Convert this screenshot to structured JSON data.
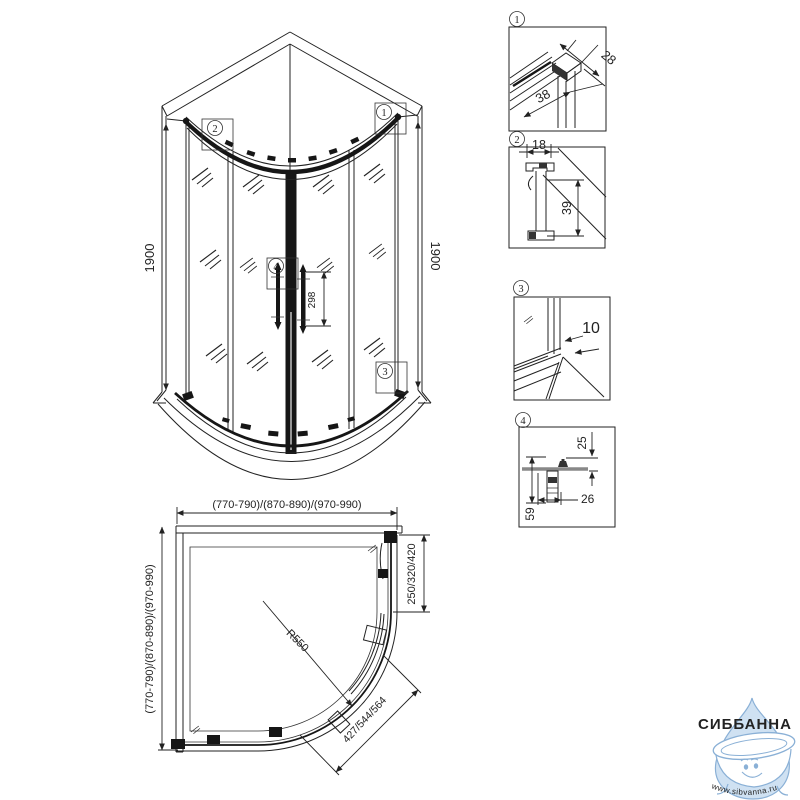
{
  "drawing": {
    "elevation": {
      "height_dim_left": "1900",
      "height_dim_right": "1900",
      "handle_dim": "298"
    },
    "plan": {
      "width_dim": "(770-790)/(870-890)/(970-990)",
      "depth_dim": "(770-790)/(870-890)/(970-990)",
      "side_opening_dim": "250/320/420",
      "door_opening_dim": "427/544/564",
      "radius_dim": "R550"
    },
    "details": {
      "d1": {
        "label": "1",
        "dim_a": "28",
        "dim_b": "38"
      },
      "d2": {
        "label": "2",
        "dim_a": "18",
        "dim_b": "39"
      },
      "d3": {
        "label": "3",
        "dim_a": "10"
      },
      "d4": {
        "label": "4",
        "dim_a": "25",
        "dim_b": "26",
        "dim_c": "59"
      }
    }
  },
  "watermark": {
    "brand": "СИББАННА",
    "website": "www.sibvanna.ru",
    "colors": {
      "brand_text": "#a6c7e5",
      "drop_fill": "#cfe1f2",
      "outline": "#8ab0d6",
      "website_text": "#7aa6d2"
    }
  }
}
